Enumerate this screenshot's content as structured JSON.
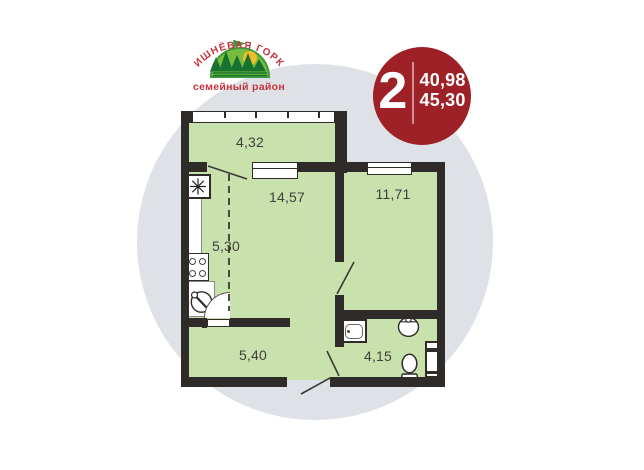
{
  "logo": {
    "title": "ВИШНЁВАЯ ГОРКА",
    "subtitle": "семейный район"
  },
  "badge": {
    "rooms_count": "2",
    "area_top": "40,98",
    "area_bottom": "45,30"
  },
  "plan": {
    "areas": {
      "loggia": "4,32",
      "living_room": "14,57",
      "bedroom": "11,71",
      "kitchen": "5,30",
      "hallway": "5,40",
      "bathroom": "4,15"
    }
  },
  "colors": {
    "badge_red": "#9d2127",
    "logo_red": "#c4343e",
    "room_green": "#c9e2ad",
    "wall_dark": "#2e2b28",
    "background_circle": "#dee2e7",
    "hill_green": "#76bd3d",
    "tree_green": "#17712f",
    "sun_yellow": "#f1bc2b"
  }
}
